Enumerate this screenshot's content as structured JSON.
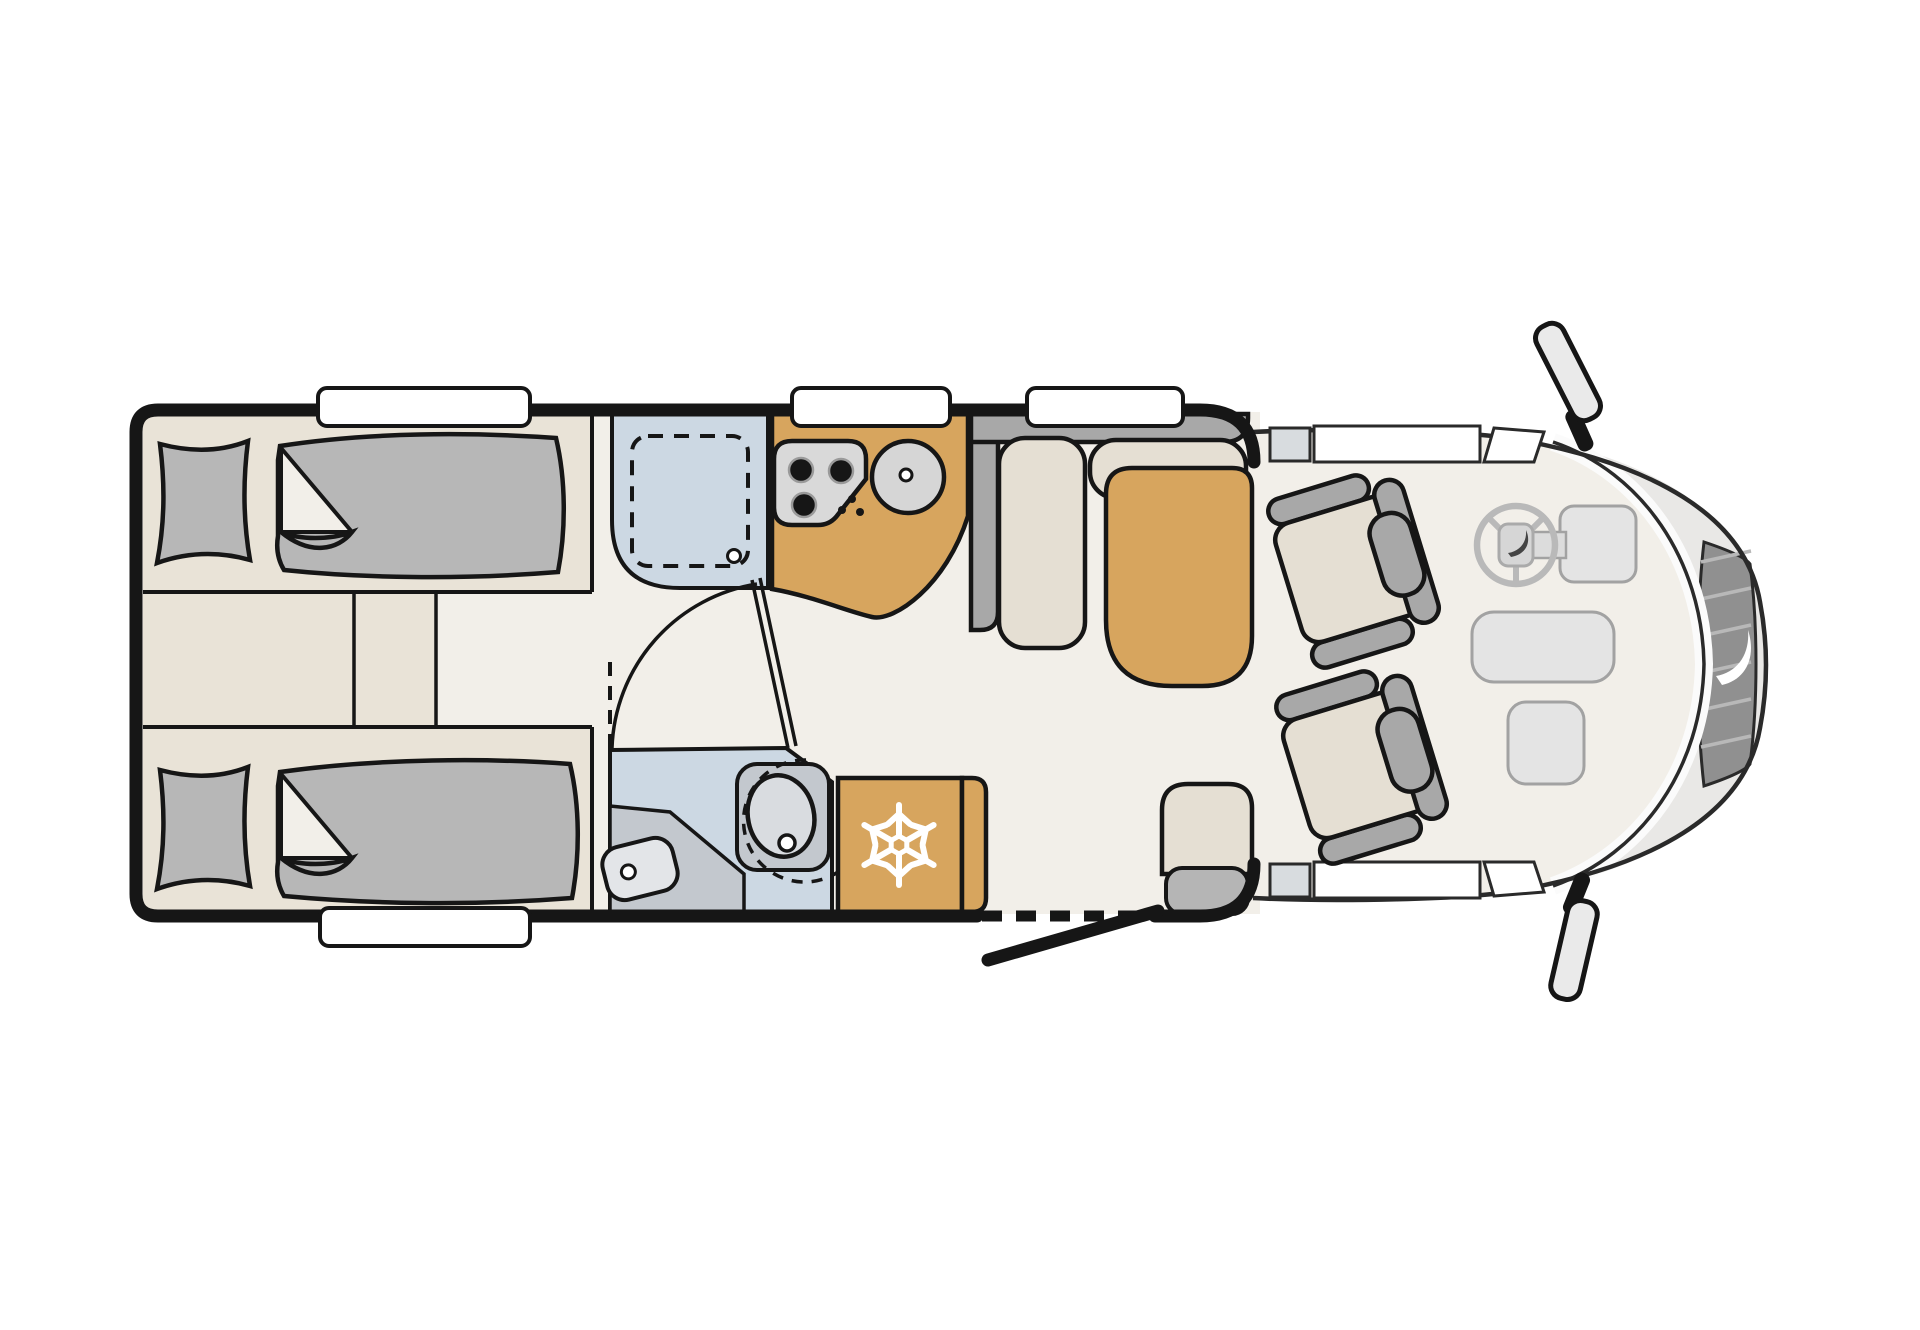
{
  "meta": {
    "type": "motorhome-floor-plan",
    "view": "top-down",
    "orientation": "cab-on-right",
    "canvas": {
      "width": 1920,
      "height": 1330
    },
    "background": "#ffffff"
  },
  "palette": {
    "ink": "#161616",
    "cab-ink": "#2a2a2a",
    "floor": "#f2efe9",
    "platform": "#e9e3d7",
    "cushion": "#e5dfd3",
    "upholstery": "#a8a8a8",
    "bedding": "#b7b7b7",
    "wet": "#ccd8e3",
    "wet-gray": "#c3c8ce",
    "tan": "#d7a55e",
    "hood": "#e9e8e6",
    "grille": "#909090",
    "glass": "#fbfbfb",
    "window": "#ffffff",
    "sill": "#d8dcdf",
    "console": "#e4e4e4",
    "console-line": "#a2a2a2",
    "wheel": "#b9b9b9",
    "mirror": "#eaeaea",
    "step": "#b5b5b5",
    "basin": "#d9dce0",
    "toilet": "#e3e5e8",
    "hatch": "#b8b8b8",
    "hob": "#d9d9d9",
    "sink": "#d6d6d6",
    "white": "#ffffff"
  },
  "counts": {
    "roof_windows_top_wall": 3,
    "roof_windows_bottom_wall": 1,
    "single_beds": 2,
    "hob_burners": 3,
    "cab_seats": 2,
    "side_mirrors": 2
  },
  "fixtures": [
    "twin-bed-top",
    "twin-bed-bottom",
    "bed-steps-aisle",
    "shower-cubicle",
    "kitchen-counter",
    "hob-icon",
    "sink-icon",
    "dinette-bench",
    "dinette-table",
    "bathroom",
    "swivel-washbasin",
    "cassette-toilet",
    "fridge",
    "snowflake-icon",
    "entry-door",
    "entry-step-sideboard",
    "driver-seat",
    "passenger-seat",
    "steering-wheel-icon",
    "dashboard-consoles",
    "front-grille",
    "brand-swoosh-icon",
    "side-mirror-top",
    "side-mirror-bottom"
  ]
}
